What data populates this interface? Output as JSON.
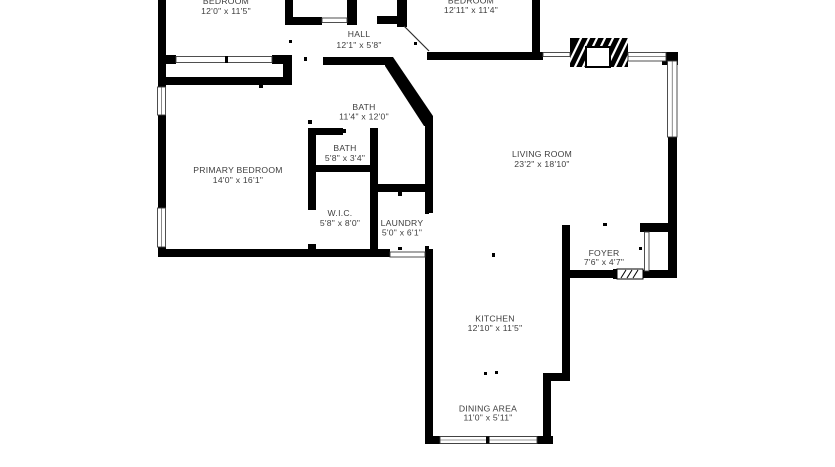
{
  "colors": {
    "wall": "#000000",
    "label": "#3d3d3d",
    "background": "#ffffff"
  },
  "floorplan": {
    "rooms": [
      {
        "name": "BEDROOM",
        "dims": "12'0\" x 11'5\""
      },
      {
        "name": "BEDROOM",
        "dims": "12'11\" x 11'4\""
      },
      {
        "name": "HALL",
        "dims": "12'1\" x 5'8\""
      },
      {
        "name": "BATH",
        "dims": "11'4\" x 12'0\""
      },
      {
        "name": "BATH",
        "dims": "5'8\" x 3'4\""
      },
      {
        "name": "PRIMARY BEDROOM",
        "dims": "14'0\" x 16'1\""
      },
      {
        "name": "W.I.C.",
        "dims": "5'8\" x 8'0\""
      },
      {
        "name": "LAUNDRY",
        "dims": "5'0\" x 6'1\""
      },
      {
        "name": "LIVING ROOM",
        "dims": "23'2\" x 18'10\""
      },
      {
        "name": "FOYER",
        "dims": "7'6\" x 4'7\""
      },
      {
        "name": "KITCHEN",
        "dims": "12'10\" x 11'5\""
      },
      {
        "name": "DINING AREA",
        "dims": "11'0\" x 5'11\""
      }
    ]
  }
}
